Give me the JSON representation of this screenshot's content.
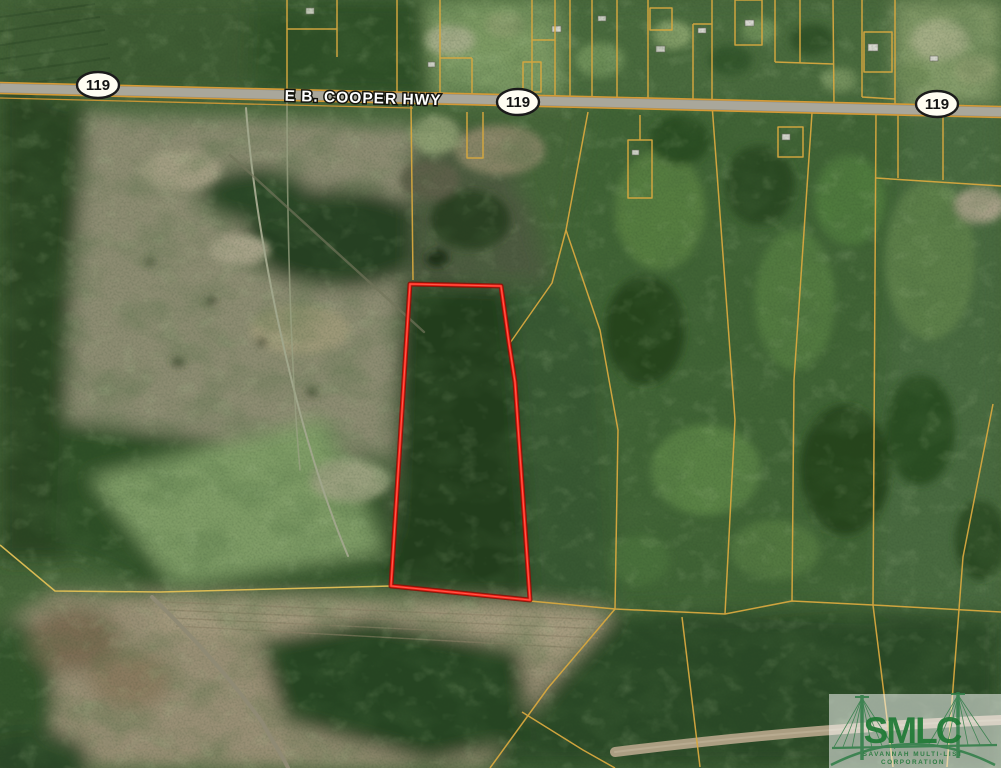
{
  "map": {
    "highway_label": "E B. COOPER HWY",
    "route_shields": [
      "119",
      "119",
      "119"
    ],
    "boundary_color": "#ff2115",
    "parcel_line_color": "#d7a83f",
    "shield_fill": "#fffdf2"
  },
  "watermark": {
    "acronym": "SMLC",
    "org_line1": "SAVANNAH MULTI-LIST",
    "org_line2": "CORPORATION"
  }
}
